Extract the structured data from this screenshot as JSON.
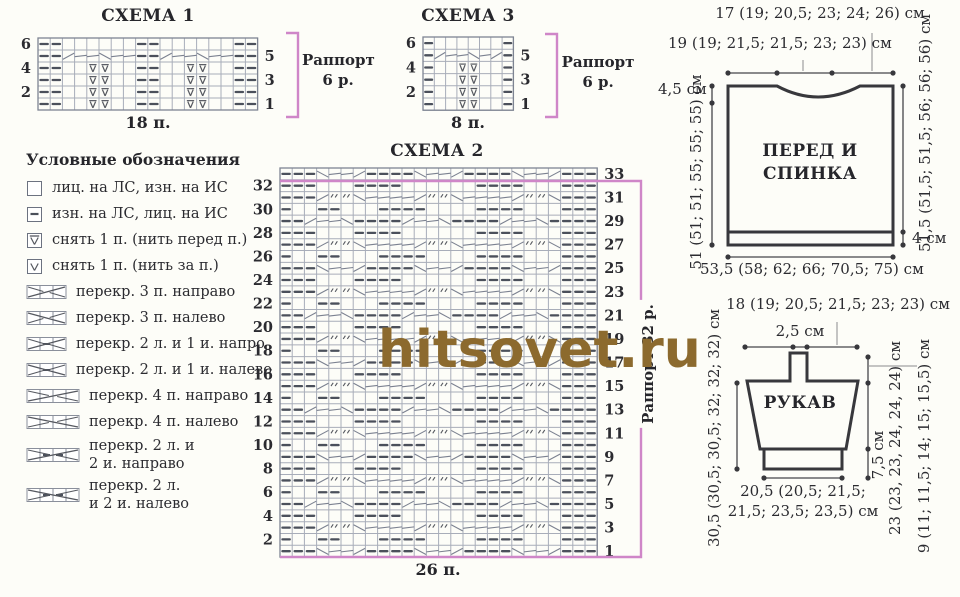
{
  "watermark": "hitsovet.ru",
  "colors": {
    "accent_pink": "#cf86c8",
    "ink": "#2b2b30",
    "symbol": "#4b505b",
    "grid": "#a8adb9",
    "outline": "#38383c",
    "watermark": "#8c6a2e"
  },
  "charts": {
    "chart1": {
      "title": "СХЕМА 1",
      "stitches_label": "18 п.",
      "rapport_line1": "Раппорт",
      "rapport_line2": "6 р.",
      "left_numbers": [
        "6",
        "4",
        "2"
      ],
      "right_numbers": [
        "5",
        "3",
        "1"
      ],
      "rows": [
        "--      --      --",
        "--/~~\\~~--/~~\\~~--",
        "--  bb  --  bb  --",
        "--  bb  --  bb  --",
        "--  bb  --  bb  --",
        "--  bb  --  bb  --"
      ]
    },
    "chart3": {
      "title": "СХЕМА 3",
      "stitches_label": "8 п.",
      "rapport_line1": "Раппорт",
      "rapport_line2": "6 р.",
      "left_numbers": [
        "6",
        "4",
        "2"
      ],
      "right_numbers": [
        "5",
        "3",
        "1"
      ],
      "rows": [
        "-      -",
        "-/~~\\~/-",
        "-  bb  -",
        "-  bb  -",
        "-  bb  -",
        "-  bb  -"
      ]
    },
    "chart2": {
      "title": "СХЕМА 2",
      "stitches_label": "26 п.",
      "rapport_vertical": "Раппорт 32 р.",
      "left_numbers": [
        "32",
        "30",
        "28",
        "26",
        "24",
        "22",
        "20",
        "18",
        "16",
        "14",
        "12",
        "10",
        "8",
        "6",
        "4",
        "2"
      ],
      "right_numbers": [
        "33",
        "31",
        "29",
        "27",
        "25",
        "23",
        "21",
        "19",
        "17",
        "15",
        "13",
        "11",
        "9",
        "7",
        "5",
        "3",
        "1"
      ],
      "rows": [
        "---\\~~/----\\~~/----\\~~/---",
        "---   ----      ----   ---",
        "---/77\\~~~~/77\\~~~~/77\\---",
        "-  --   ----    ----   ---",
        "--/~~\\----/~~\\----/~~\\----",
        "---   ----      ----   ---",
        "---/77\\~~~~/77\\~~~~/77\\---",
        "-  --   ----    ----   ---",
        "---\\~~/----\\~~/----\\~~/---",
        "---   ----      ----   ---",
        "---/77\\~~~~/77\\~~~~/77\\---",
        "-  --   ----    ----   ---",
        "--/~~\\----/~~\\----/~~\\----",
        "---   ----      ----   ---",
        "---/77\\~~~~/77\\~~~~/77\\---",
        "-  --   ----    ----   ---",
        "---\\~~/----\\~~/----\\~~/---",
        "---   ----      ----   ---",
        "---/77\\~~~~/77\\~~~~/77\\---",
        "-  --   ----    ----   ---",
        "--/~~\\----/~~\\----/~~\\----",
        "---   ----      ----   ---",
        "---/77\\~~~~/77\\~~~~/77\\---",
        "-  --   ----    ----   ---",
        "---\\~~/----\\~~/----\\~~/---",
        "---   ----      ----   ---",
        "---/77\\~~~~/77\\~~~~/77\\---",
        "-  --   ----    ----   ---",
        "--/~~\\----/~~\\----/~~\\----",
        "---   ----      ----   ---",
        "---/77\\~~~~/77\\~~~~/77\\---",
        "-  --   ----    ----   ---",
        "---\\~~/----\\~~/----\\~~/---"
      ]
    }
  },
  "legend": {
    "title": "Условные обозначения",
    "items": [
      {
        "symbol": "knit",
        "lines": [
          "лиц. на ЛС, изн. на ИС"
        ]
      },
      {
        "symbol": "purl",
        "lines": [
          "изн. на ЛС, лиц. на ИС"
        ]
      },
      {
        "symbol": "slip-front",
        "lines": [
          "снять 1 п. (нить перед п.)"
        ]
      },
      {
        "symbol": "slip-back",
        "lines": [
          "снять 1 п. (нить за п.)"
        ]
      },
      {
        "symbol": "cable3-right",
        "lines": [
          "перекр. 3 п. направо"
        ]
      },
      {
        "symbol": "cable3-left",
        "lines": [
          "перекр. 3 п. налево"
        ]
      },
      {
        "symbol": "cable2k1p-right",
        "lines": [
          "перекр. 2 л. и 1 и. напро"
        ]
      },
      {
        "symbol": "cable2k1p-left",
        "lines": [
          "перекр. 2 л. и 1 и. налево"
        ]
      },
      {
        "symbol": "cable4-right",
        "lines": [
          "перекр. 4 п. направо"
        ]
      },
      {
        "symbol": "cable4-left",
        "lines": [
          "перекр. 4 п. налево"
        ]
      },
      {
        "symbol": "cable2k2p-right",
        "lines": [
          "перекр. 2 л. и",
          "2 и. направо"
        ]
      },
      {
        "symbol": "cable2k2p-left",
        "lines": [
          "перекр. 2 л.",
          "и 2 и. налево"
        ]
      }
    ]
  },
  "front_back": {
    "title_line1": "ПЕРЕД И",
    "title_line2": "СПИНКА",
    "top_label_1": "17 (19; 20,5; 23; 24; 26) см",
    "top_label_2": "19 (19; 21,5; 21,5; 23; 23) см",
    "left_small": "4,5 см",
    "left_height": "51 (51; 51; 55; 55; 55) см",
    "right_height": "51,5 (51,5; 51,5; 56; 56; 56) см",
    "band": "4 см",
    "bottom_width": "53,5 (58; 62; 66; 70,5; 75) см"
  },
  "sleeve": {
    "title": "РУКАВ",
    "top_label": "18 (19; 20,5; 21,5; 23; 23) см",
    "tab_label": "2,5 см",
    "left_height": "30,5 (30,5; 30,5; 32; 32; 32) см",
    "cuff_label": "7,5 см",
    "inner_height": "23 (23, 23, 24, 24, 24) см",
    "outer_height": "9 (11; 11,5; 14; 15; 15,5) см",
    "bottom_line1": "20,5 (20,5; 21,5;",
    "bottom_line2": "21,5; 23,5; 23,5) см"
  }
}
